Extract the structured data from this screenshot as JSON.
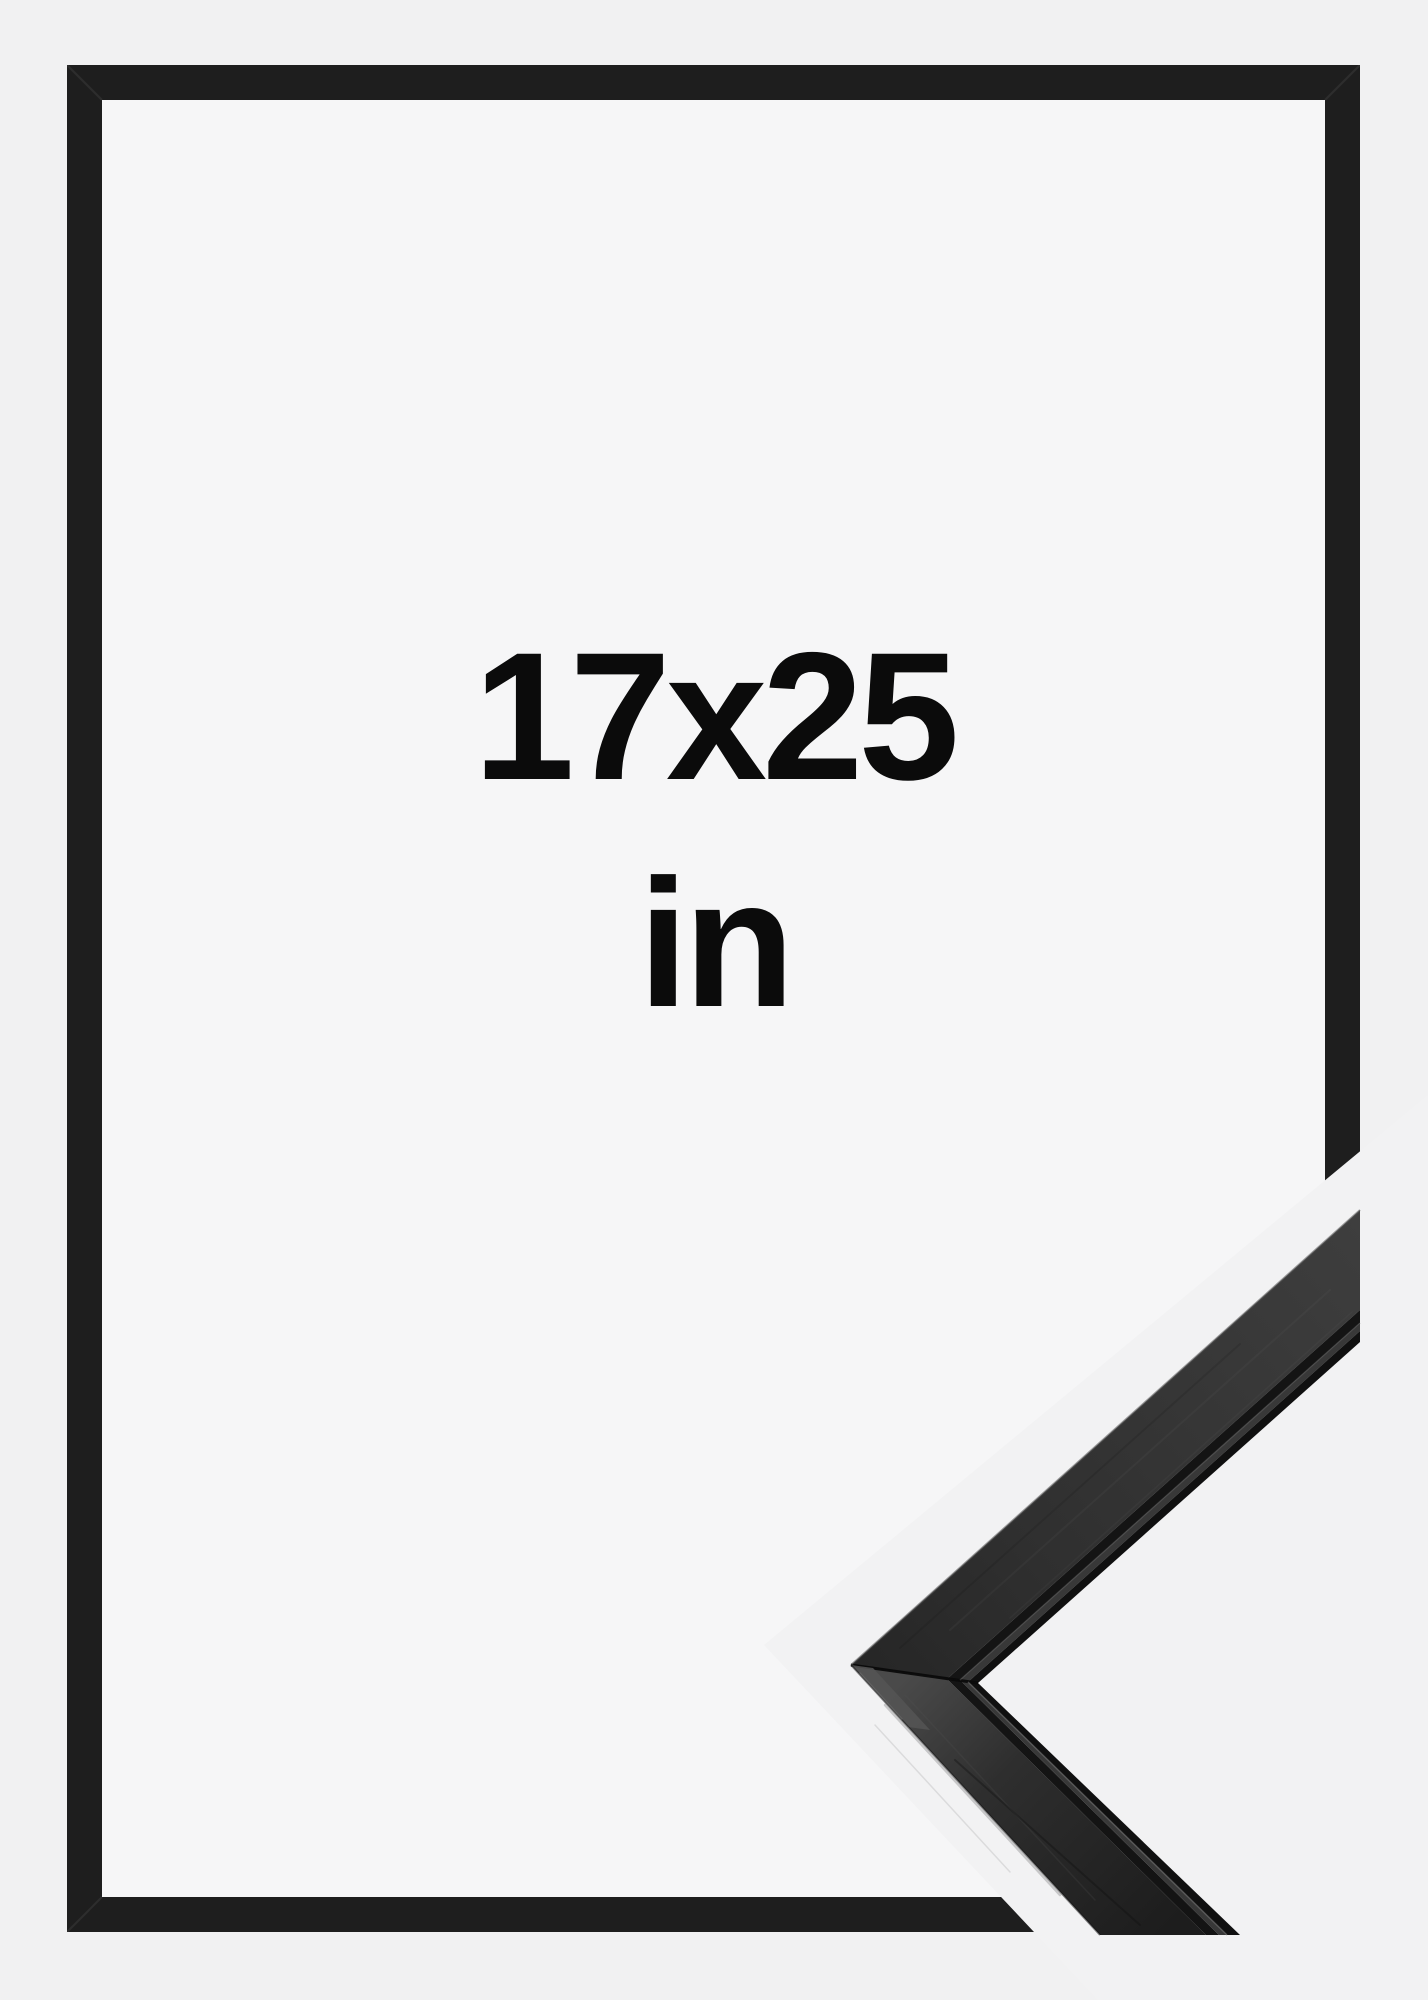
{
  "product_image": {
    "kind": "picture-frame-size-mockup",
    "size_label": {
      "line1": "17x25",
      "line2": "in"
    },
    "colors": {
      "background": "#f1f1f2",
      "frame_interior": "#f6f6f7",
      "frame_border": "#1e1e1e",
      "gap": "#f2f2f3",
      "text": "#0b0b0b",
      "moulding_face_dark": "#262626",
      "moulding_face_light": "#3e3e3e",
      "moulding_lower_light": "#4a4a4a",
      "moulding_lower_dark": "#1d1d1d",
      "moulding_groove": "#141414",
      "moulding_lip": "#383838",
      "moulding_inner_edge": "#101010"
    }
  }
}
